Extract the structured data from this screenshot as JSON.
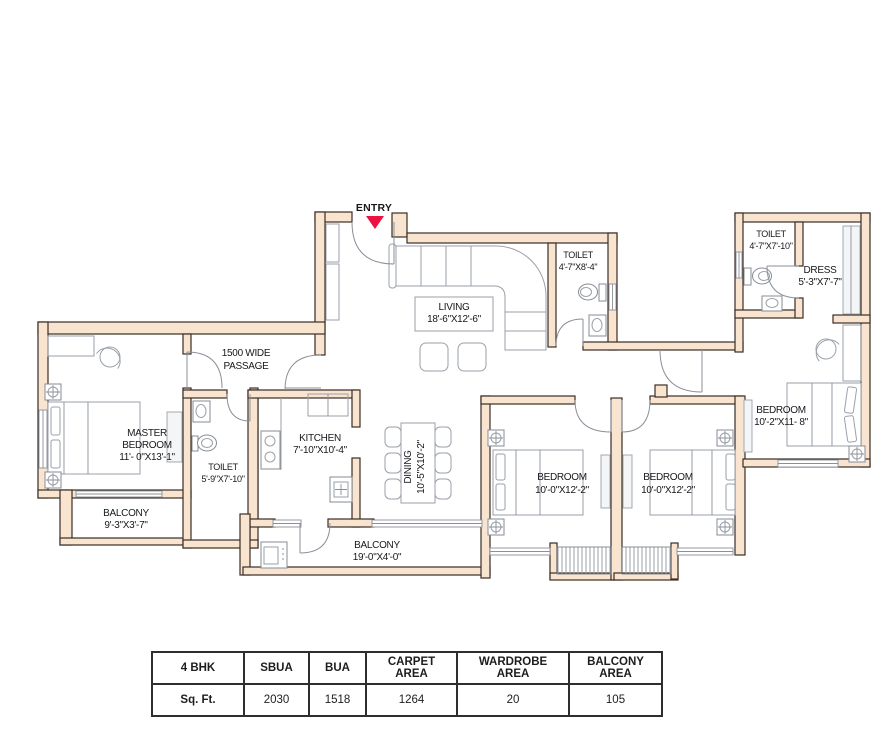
{
  "entry": {
    "label": "ENTRY"
  },
  "rooms": {
    "living": {
      "name": "LIVING",
      "dims": "18'-6\"X12'-6\""
    },
    "toilet_living": {
      "name": "TOILET",
      "dims": "4'-7\"X8'-4\""
    },
    "toilet_wing": {
      "name": "TOILET",
      "dims": "4'-7\"X7'-10\""
    },
    "dress": {
      "name": "DRESS",
      "dims": "5'-3\"X7'-7\""
    },
    "bedroom_wing": {
      "name": "BEDROOM",
      "dims": "10'-2\"X11- 8\""
    },
    "master_bedroom": {
      "name1": "MASTER",
      "name2": "BEDROOM",
      "dims": "11'- 0\"X13'-1\""
    },
    "passage": {
      "line1": "1500 WIDE",
      "line2": "PASSAGE"
    },
    "toilet_master": {
      "name": "TOILET",
      "dims": "5'-9\"X7'-10\""
    },
    "kitchen": {
      "name": "KITCHEN",
      "dims": "7'-10\"X10'-4\""
    },
    "dining": {
      "name": "DINING",
      "dims": "10'-5\"X10'-2\""
    },
    "balcony_master": {
      "name": "BALCONY",
      "dims": "9'-3\"X3'-7\""
    },
    "balcony_main": {
      "name": "BALCONY",
      "dims": "19'-0\"X4'-0\""
    },
    "bedroom_mid_left": {
      "name": "BEDROOM",
      "dims": "10'-0\"X12'-2\""
    },
    "bedroom_mid_right": {
      "name": "BEDROOM",
      "dims": "10'-0\"X12'-2\""
    }
  },
  "area_table": {
    "headers": [
      "4 BHK",
      "SBUA",
      "BUA",
      "CARPET AREA",
      "WARDROBE AREA",
      "BALCONY AREA"
    ],
    "row_label": "Sq. Ft.",
    "values": [
      "2030",
      "1518",
      "1264",
      "20",
      "105"
    ]
  },
  "colors": {
    "wall_fill": "#f9e4d0",
    "wall_outline": "#3a2d26",
    "entry_arrow": "#ee1040",
    "furniture_gray": "#9aa1a8",
    "table_border": "#2e2e2e"
  }
}
